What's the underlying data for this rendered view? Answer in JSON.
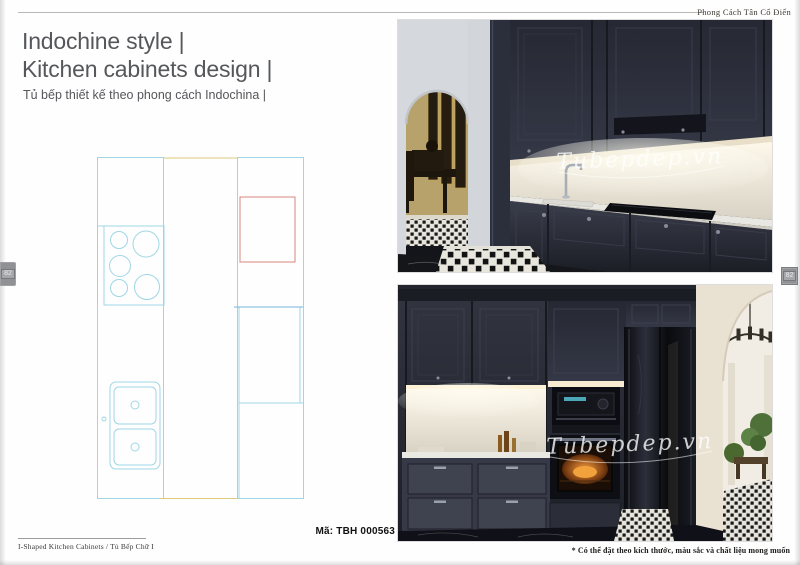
{
  "page": {
    "header": {
      "label": "Phong Cách Tân Cổ Điển"
    },
    "title": {
      "line1": "Indochine style |",
      "line2": "Kitchen cabinets design |",
      "subtitle": "Tủ bếp thiết kế theo phong cách Indochina |"
    },
    "product_code": "Mã: TBH 000563",
    "footer": {
      "left": "I-Shaped Kitchen Cabinets  /  Tủ Bếp Chữ I",
      "right": "* Có thể đặt theo kích thước, màu sắc và chất liệu mong muốn"
    },
    "page_tabs": {
      "left": "82",
      "right": "82"
    },
    "watermark": "Tubepdep.vn"
  },
  "floor_plan": {
    "type": "kitchen-layout-diagram",
    "fixtures": [
      "left-cabinet-run",
      "cooktop-five-burners",
      "double-bowl-sink",
      "walkway",
      "right-cabinet-run",
      "refrigerator-outline"
    ],
    "line_colors": {
      "cabinet": "#9fd6e6",
      "refrigerator": "#d8877e",
      "walkway": "#dfca7a",
      "counter_divider": "#74b7dc"
    }
  },
  "photos": [
    {
      "name": "kitchen-photo-top",
      "subject": "navy kitchen cabinets, white backsplash, sink and cooktop, arched doorway to dining room at left"
    },
    {
      "name": "kitchen-photo-bottom",
      "subject": "navy built-in wall with microwave, oven and refrigerator, arched doorway to dining room at right"
    }
  ],
  "colors": {
    "cabinet_navy": "#272935",
    "backsplash": "#efece3",
    "title_text": "#56575a",
    "page_tab": "#8f9194"
  }
}
